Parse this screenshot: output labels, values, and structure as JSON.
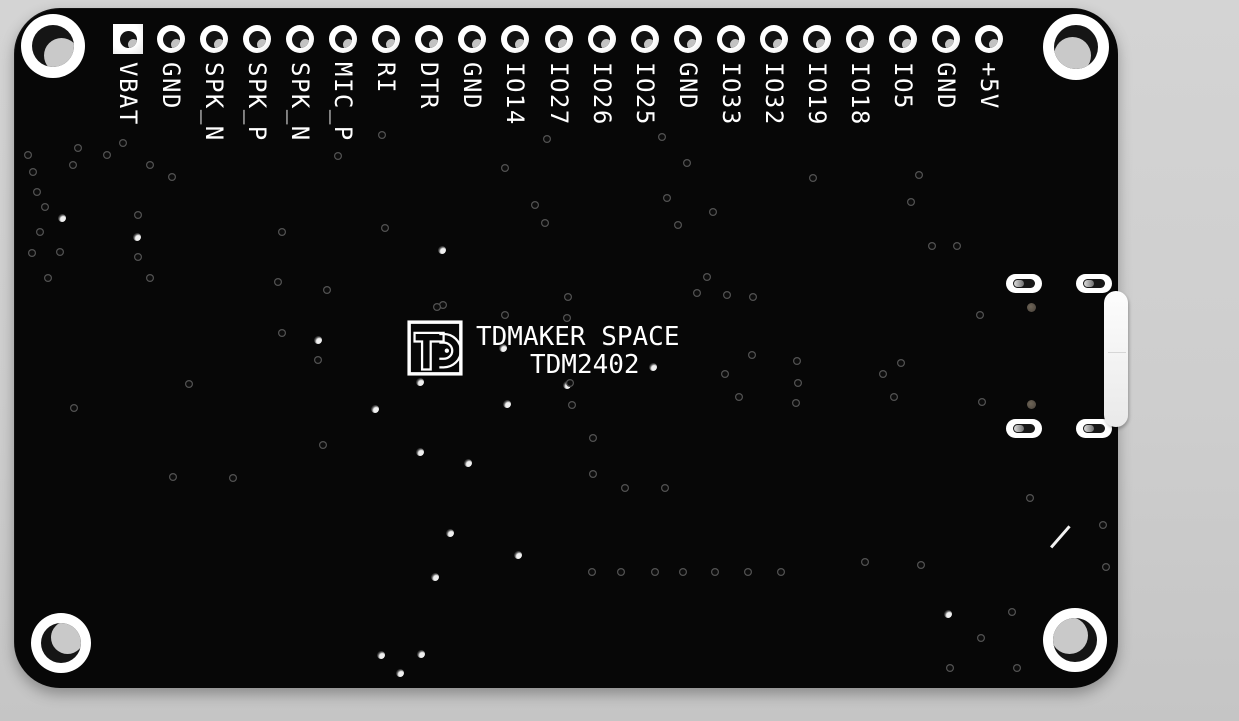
{
  "meta": {
    "description": "PCB back-side 3D render",
    "board_name": "TDM2402"
  },
  "colors": {
    "background_top": "#d4d4d4",
    "background_bottom": "#c5c5c5",
    "board": "#070707",
    "silkscreen": "#ffffff",
    "pad": "#ffffff",
    "hole_dark": "#151515",
    "hole_background": "#c9c9c9",
    "plated_dot": "#5e5649"
  },
  "board": {
    "x": 14,
    "y": 8,
    "width": 1104,
    "height": 680,
    "corner_radius": 46
  },
  "silkscreen": {
    "title_line1": "TDMAKER SPACE",
    "title_line2": "TDM2402",
    "logo": {
      "x": 407,
      "y": 320,
      "size": 56
    },
    "title1_pos": {
      "x": 476,
      "y": 322
    },
    "title2_pos": {
      "x": 530,
      "y": 350
    },
    "diagonal_line": {
      "x": 1051,
      "y": 546,
      "length": 28,
      "angle_deg": -49
    }
  },
  "pin_header": {
    "start_x": 128,
    "pitch": 43.05,
    "pad_center_y": 39,
    "label_top": 62,
    "pins": [
      {
        "label": "VBAT",
        "shape": "square"
      },
      {
        "label": "GND",
        "shape": "round"
      },
      {
        "label": "SPK_N",
        "shape": "round"
      },
      {
        "label": "SPK_P",
        "shape": "round"
      },
      {
        "label": "SPK_N",
        "shape": "round"
      },
      {
        "label": "MIC_P",
        "shape": "round"
      },
      {
        "label": "RI",
        "shape": "round"
      },
      {
        "label": "DTR",
        "shape": "round"
      },
      {
        "label": "GND",
        "shape": "round"
      },
      {
        "label": "IO14",
        "shape": "round"
      },
      {
        "label": "IO27",
        "shape": "round"
      },
      {
        "label": "IO26",
        "shape": "round"
      },
      {
        "label": "IO25",
        "shape": "round"
      },
      {
        "label": "GND",
        "shape": "round"
      },
      {
        "label": "IO33",
        "shape": "round"
      },
      {
        "label": "IO32",
        "shape": "round"
      },
      {
        "label": "IO19",
        "shape": "round"
      },
      {
        "label": "IO18",
        "shape": "round"
      },
      {
        "label": "IO5",
        "shape": "round"
      },
      {
        "label": "GND",
        "shape": "round"
      },
      {
        "label": "+5V",
        "shape": "round"
      }
    ]
  },
  "mounting_holes": [
    {
      "x": 53,
      "y": 46,
      "outer": 64,
      "hole": 42,
      "bg_dx": 8,
      "bg_dy": 9
    },
    {
      "x": 1076,
      "y": 47,
      "outer": 66,
      "hole": 44,
      "bg_dx": -4,
      "bg_dy": 8
    },
    {
      "x": 61,
      "y": 643,
      "outer": 60,
      "hole": 40,
      "bg_dx": 6,
      "bg_dy": -6
    },
    {
      "x": 1075,
      "y": 640,
      "outer": 64,
      "hole": 44,
      "bg_dx": -6,
      "bg_dy": -5
    }
  ],
  "smd_pads": {
    "size": {
      "w": 36,
      "h": 19
    },
    "positions": [
      {
        "x": 1024,
        "y": 283
      },
      {
        "x": 1094,
        "y": 283
      },
      {
        "x": 1024,
        "y": 428
      },
      {
        "x": 1094,
        "y": 428
      }
    ]
  },
  "plated_dots": [
    {
      "x": 1031,
      "y": 307
    },
    {
      "x": 1031,
      "y": 404
    }
  ],
  "usb_tab": {
    "x": 1104,
    "y": 291,
    "width": 24,
    "height": 136,
    "seam_y": 352
  },
  "vias": [
    [
      28,
      155,
      0
    ],
    [
      33,
      172,
      0
    ],
    [
      78,
      148,
      0
    ],
    [
      107,
      155,
      0
    ],
    [
      123,
      143,
      0
    ],
    [
      73,
      165,
      0
    ],
    [
      150,
      165,
      0
    ],
    [
      172,
      177,
      0
    ],
    [
      37,
      192,
      0
    ],
    [
      45,
      207,
      0
    ],
    [
      62,
      218,
      1
    ],
    [
      40,
      232,
      0
    ],
    [
      32,
      253,
      0
    ],
    [
      60,
      252,
      0
    ],
    [
      48,
      278,
      0
    ],
    [
      138,
      215,
      0
    ],
    [
      137,
      237,
      1
    ],
    [
      138,
      257,
      0
    ],
    [
      150,
      278,
      0
    ],
    [
      282,
      232,
      0
    ],
    [
      278,
      282,
      0
    ],
    [
      282,
      333,
      0
    ],
    [
      318,
      340,
      1
    ],
    [
      318,
      360,
      0
    ],
    [
      338,
      156,
      0
    ],
    [
      382,
      135,
      0
    ],
    [
      505,
      168,
      0
    ],
    [
      547,
      139,
      0
    ],
    [
      535,
      205,
      0
    ],
    [
      545,
      223,
      0
    ],
    [
      385,
      228,
      0
    ],
    [
      442,
      250,
      1
    ],
    [
      327,
      290,
      0
    ],
    [
      443,
      305,
      0
    ],
    [
      568,
      297,
      0
    ],
    [
      662,
      137,
      0
    ],
    [
      687,
      163,
      0
    ],
    [
      667,
      198,
      0
    ],
    [
      713,
      212,
      0
    ],
    [
      678,
      225,
      0
    ],
    [
      707,
      277,
      0
    ],
    [
      697,
      293,
      0
    ],
    [
      813,
      178,
      0
    ],
    [
      919,
      175,
      0
    ],
    [
      911,
      202,
      0
    ],
    [
      932,
      246,
      0
    ],
    [
      957,
      246,
      0
    ],
    [
      727,
      295,
      0
    ],
    [
      753,
      297,
      0
    ],
    [
      980,
      315,
      0
    ],
    [
      752,
      355,
      0
    ],
    [
      797,
      361,
      0
    ],
    [
      725,
      374,
      0
    ],
    [
      901,
      363,
      0
    ],
    [
      883,
      374,
      0
    ],
    [
      798,
      383,
      0
    ],
    [
      739,
      397,
      0
    ],
    [
      894,
      397,
      0
    ],
    [
      982,
      402,
      0
    ],
    [
      796,
      403,
      0
    ],
    [
      437,
      307,
      0
    ],
    [
      505,
      315,
      0
    ],
    [
      567,
      318,
      0
    ],
    [
      503,
      348,
      1
    ],
    [
      567,
      385,
      1
    ],
    [
      653,
      367,
      1
    ],
    [
      420,
      382,
      1
    ],
    [
      375,
      409,
      1
    ],
    [
      323,
      445,
      0
    ],
    [
      420,
      452,
      1
    ],
    [
      468,
      463,
      1
    ],
    [
      507,
      404,
      1
    ],
    [
      570,
      383,
      0
    ],
    [
      572,
      405,
      0
    ],
    [
      593,
      438,
      0
    ],
    [
      593,
      474,
      0
    ],
    [
      625,
      488,
      0
    ],
    [
      665,
      488,
      0
    ],
    [
      450,
      533,
      1
    ],
    [
      518,
      555,
      1
    ],
    [
      435,
      577,
      1
    ],
    [
      189,
      384,
      0
    ],
    [
      74,
      408,
      0
    ],
    [
      173,
      477,
      0
    ],
    [
      233,
      478,
      0
    ],
    [
      592,
      572,
      0
    ],
    [
      621,
      572,
      0
    ],
    [
      655,
      572,
      0
    ],
    [
      683,
      572,
      0
    ],
    [
      715,
      572,
      0
    ],
    [
      748,
      572,
      0
    ],
    [
      781,
      572,
      0
    ],
    [
      865,
      562,
      0
    ],
    [
      921,
      565,
      0
    ],
    [
      948,
      614,
      1
    ],
    [
      1012,
      612,
      0
    ],
    [
      981,
      638,
      0
    ],
    [
      950,
      668,
      0
    ],
    [
      1017,
      668,
      0
    ],
    [
      381,
      655,
      1
    ],
    [
      421,
      654,
      1
    ],
    [
      400,
      673,
      1
    ],
    [
      1030,
      498,
      0
    ],
    [
      1103,
      525,
      0
    ],
    [
      1106,
      567,
      0
    ]
  ]
}
